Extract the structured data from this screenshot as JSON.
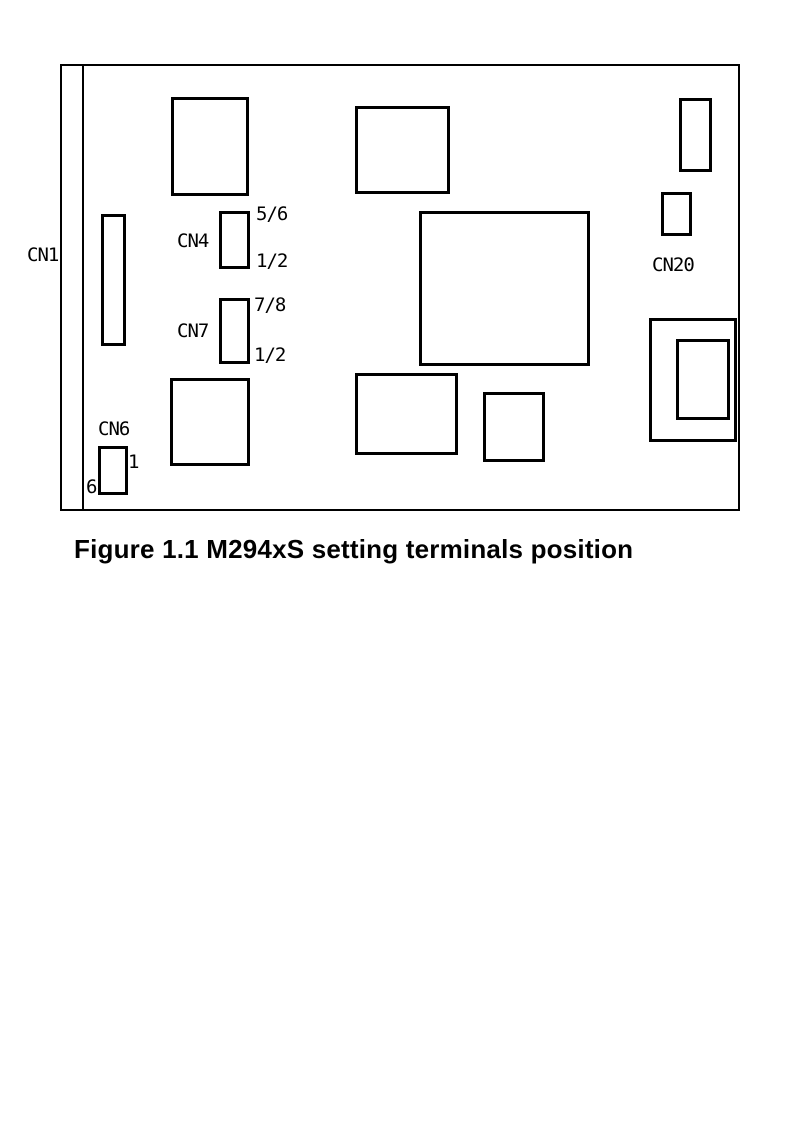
{
  "caption": "Figure 1.1 M294xS setting terminals position",
  "diagram": {
    "ink_color": "#000000",
    "background_color": "#ffffff",
    "board": {
      "x": 60,
      "y": 64,
      "w": 680,
      "h": 447
    },
    "card_edge_line": {
      "x": 82,
      "y": 64,
      "w": 2,
      "h": 447
    },
    "components": [
      {
        "name": "component-rect-top-left",
        "x": 171,
        "y": 97,
        "w": 78,
        "h": 99
      },
      {
        "name": "component-rect-top-middle",
        "x": 355,
        "y": 106,
        "w": 95,
        "h": 88
      },
      {
        "name": "component-rect-top-right",
        "x": 679,
        "y": 98,
        "w": 33,
        "h": 74
      },
      {
        "name": "connector-cn1-rect",
        "x": 101,
        "y": 214,
        "w": 25,
        "h": 132
      },
      {
        "name": "connector-cn4-rect",
        "x": 219,
        "y": 211,
        "w": 31,
        "h": 58
      },
      {
        "name": "connector-cn20-rect",
        "x": 661,
        "y": 192,
        "w": 31,
        "h": 44
      },
      {
        "name": "component-ic-center",
        "x": 419,
        "y": 211,
        "w": 171,
        "h": 155
      },
      {
        "name": "connector-cn7-rect",
        "x": 219,
        "y": 298,
        "w": 31,
        "h": 66
      },
      {
        "name": "component-rect-bottom-left",
        "x": 170,
        "y": 378,
        "w": 80,
        "h": 88
      },
      {
        "name": "component-rect-bottom-middle",
        "x": 355,
        "y": 373,
        "w": 103,
        "h": 82
      },
      {
        "name": "component-rect-bottom-small",
        "x": 483,
        "y": 392,
        "w": 62,
        "h": 70
      },
      {
        "name": "connector-cn6-rect",
        "x": 98,
        "y": 446,
        "w": 30,
        "h": 49
      },
      {
        "name": "component-rect-bottom-right-outer",
        "x": 649,
        "y": 318,
        "w": 88,
        "h": 124
      },
      {
        "name": "component-rect-bottom-right-inner",
        "x": 676,
        "y": 339,
        "w": 54,
        "h": 81
      }
    ],
    "labels": [
      {
        "name": "label-cn1",
        "text": "CN1",
        "x": 27,
        "y": 246
      },
      {
        "name": "label-cn4",
        "text": "CN4",
        "x": 177,
        "y": 232
      },
      {
        "name": "label-cn4-pin56",
        "text": "5/6",
        "x": 256,
        "y": 205
      },
      {
        "name": "label-cn4-pin12",
        "text": "1/2",
        "x": 256,
        "y": 252
      },
      {
        "name": "label-cn7",
        "text": "CN7",
        "x": 177,
        "y": 322
      },
      {
        "name": "label-cn7-pin78",
        "text": "7/8",
        "x": 254,
        "y": 296
      },
      {
        "name": "label-cn7-pin12",
        "text": "1/2",
        "x": 254,
        "y": 346
      },
      {
        "name": "label-cn6",
        "text": "CN6",
        "x": 98,
        "y": 420
      },
      {
        "name": "label-cn6-pin1",
        "text": "1",
        "x": 128,
        "y": 453
      },
      {
        "name": "label-cn6-pin6",
        "text": "6",
        "x": 86,
        "y": 478
      },
      {
        "name": "label-cn20",
        "text": "CN20",
        "x": 652,
        "y": 256
      }
    ]
  }
}
